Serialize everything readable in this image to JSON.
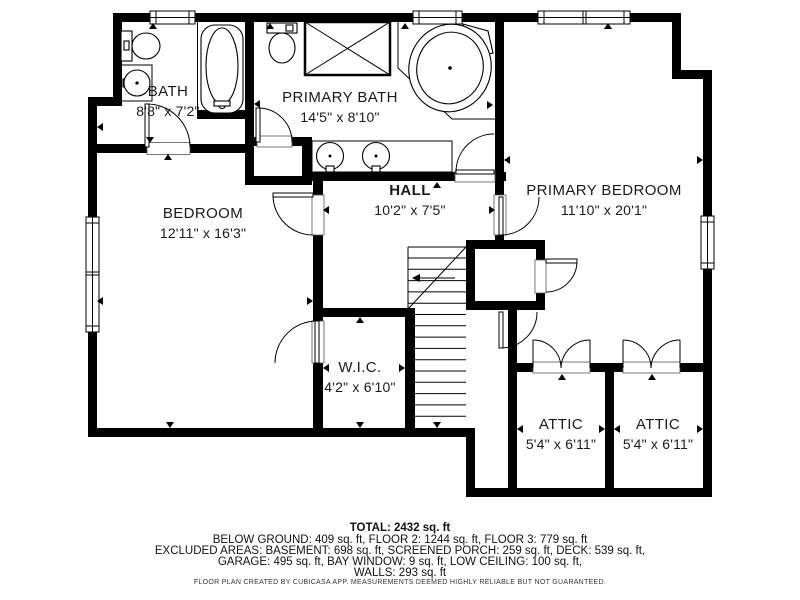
{
  "rooms": [
    {
      "name": "BATH",
      "dims": "8'8\" x 7'2\""
    },
    {
      "name": "PRIMARY BATH",
      "dims": "14'5\" x 8'10\""
    },
    {
      "name": "BEDROOM",
      "dims": "12'11\" x 16'3\""
    },
    {
      "name": "HALL",
      "dims": "10'2\" x 7'5\""
    },
    {
      "name": "PRIMARY BEDROOM",
      "dims": "11'10\" x 20'1\""
    },
    {
      "name": "W.I.C.",
      "dims": "4'2\" x 6'10\""
    },
    {
      "name": "ATTIC",
      "dims": "5'4\" x 6'11\""
    },
    {
      "name": "ATTIC",
      "dims": "5'4\" x 6'11\""
    }
  ],
  "footer": {
    "total": "TOTAL: 2432 sq. ft",
    "line1": "BELOW GROUND: 409 sq. ft, FLOOR 2: 1244 sq. ft, FLOOR 3: 779 sq. ft",
    "line2": "EXCLUDED AREAS: BASEMENT: 698 sq. ft, SCREENED PORCH: 259 sq. ft, DECK: 539 sq. ft,",
    "line3": "GARAGE: 495 sq. ft, BAY WINDOW: 9 sq. ft, LOW CEILING: 100 sq. ft,",
    "line4": "WALLS: 293 sq. ft",
    "disclaimer": "FLOOR PLAN CREATED BY CUBICASA APP. MEASUREMENTS DEEMED HIGHLY RELIABLE BUT NOT GUARANTEED."
  },
  "colors": {
    "wall": "#000000",
    "background": "#ffffff",
    "text": "#111111"
  }
}
